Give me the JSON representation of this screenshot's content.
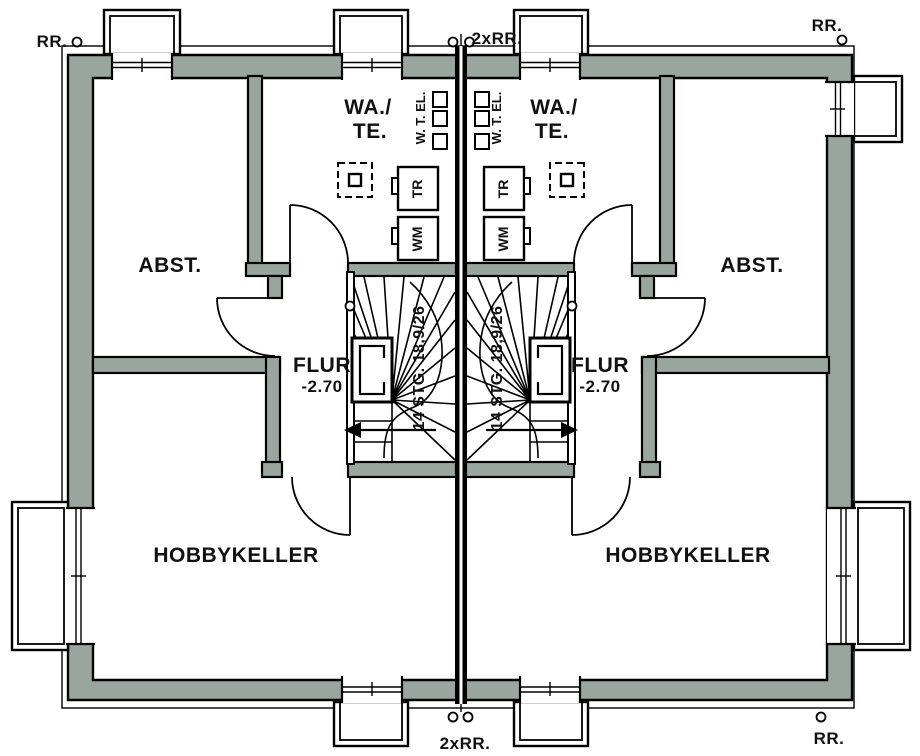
{
  "drawing": {
    "pipes": {
      "top_left": "RR.",
      "top_center": "2xRR.",
      "top_right": "RR.",
      "bottom_center": "2xRR.",
      "bottom_right": "RR."
    },
    "rooms": {
      "storage": "ABST.",
      "laundry_line1": "WA./",
      "laundry_line2": "TE.",
      "hall": "FLUR",
      "hall_level": "-2.70",
      "hobby": "HOBBYKELLER"
    },
    "stair": {
      "label": "14 STG. 18,9/26"
    },
    "fixtures": {
      "utilities": "W. T. EL.",
      "dryer": "TR",
      "washer": "WM"
    },
    "colors": {
      "wall_fill": "#99A6A0",
      "line": "#000000",
      "background": "#FFFFFF"
    }
  }
}
